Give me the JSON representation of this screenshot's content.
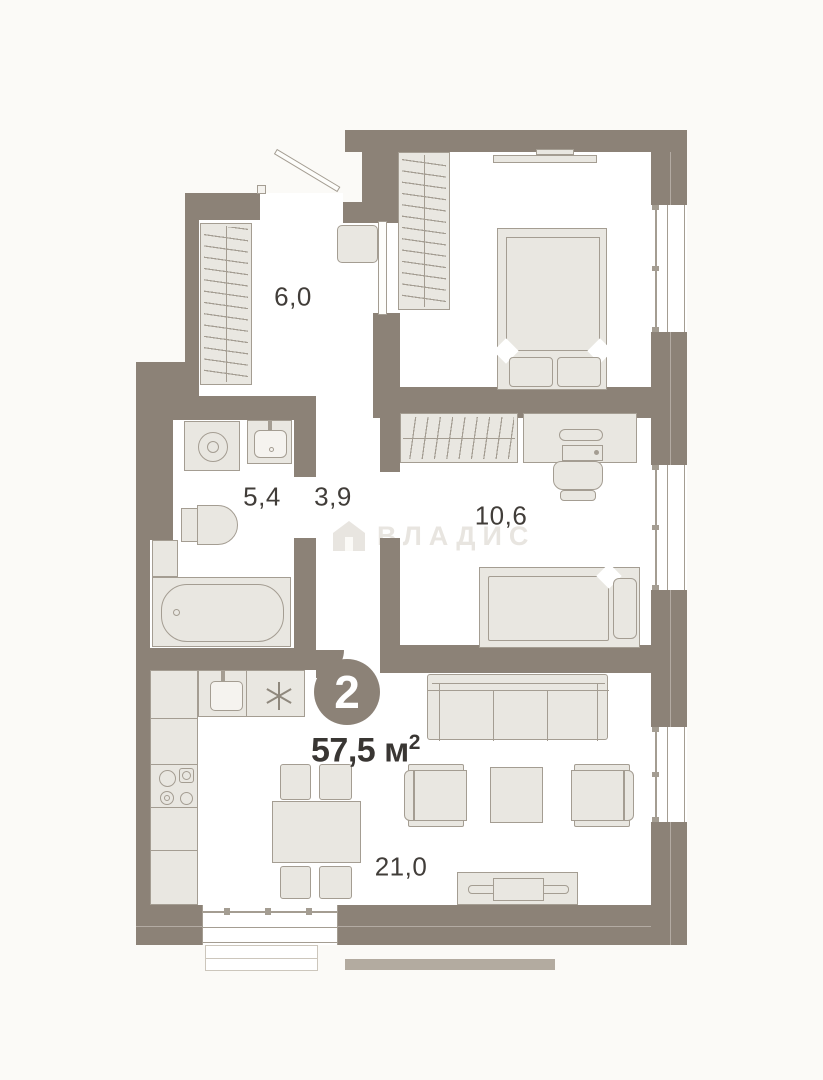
{
  "plan": {
    "badge": {
      "rooms_count": "2",
      "area_value": "57,5",
      "area_unit": "м",
      "area_sup": "2"
    },
    "room_areas": {
      "hallway": "6,0",
      "bathroom": "5,4",
      "corridor": "3,9",
      "bedroom": "10,6",
      "living_kitchen": "21,0"
    },
    "watermark": {
      "text": "ВЛАДИС"
    },
    "colors": {
      "background": "#fbfaf7",
      "floor": "#ffffff",
      "wall": "#8c8277",
      "furniture_fill": "#e9e7e1",
      "furniture_stroke": "#a49d92",
      "label_text": "#413d39",
      "watermark": "#e8e5e0"
    }
  }
}
